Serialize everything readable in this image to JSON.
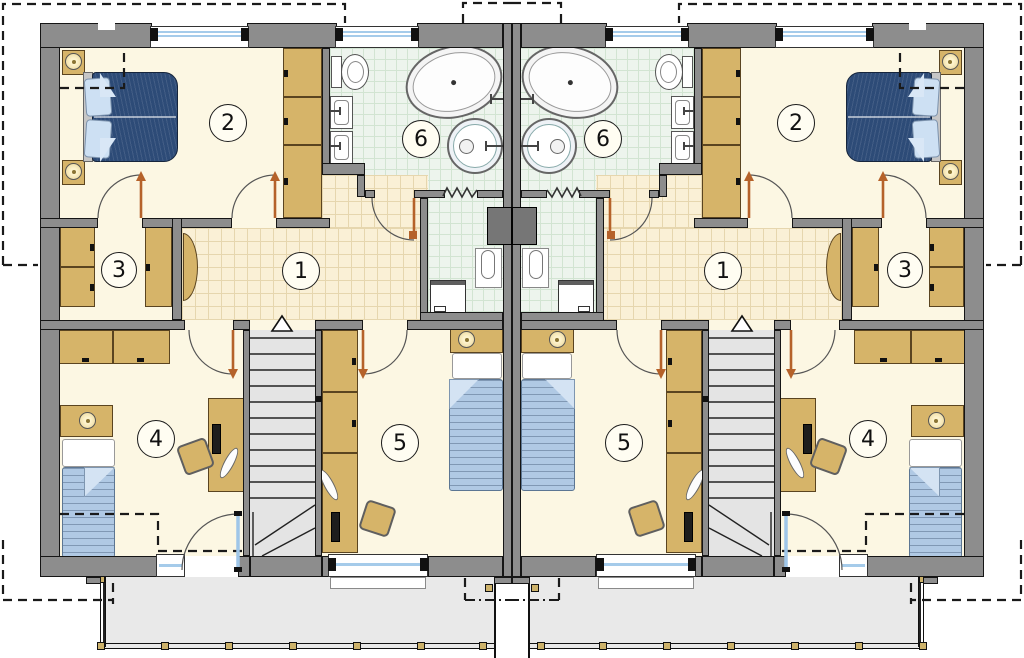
{
  "plan": {
    "type": "floor-plan",
    "rooms": {
      "r1": {
        "label": "1"
      },
      "r2": {
        "label": "2"
      },
      "r3": {
        "label": "3"
      },
      "r4": {
        "label": "4"
      },
      "r5": {
        "label": "5"
      },
      "r6": {
        "label": "6"
      }
    },
    "colors": {
      "wall": "#8d8d8d",
      "wallEdge": "#151515",
      "cream": "#fcf7e3",
      "hallBase": "#faf0d6",
      "hallLine": "#e6d6ae",
      "bathBase": "#edf4ed",
      "bathLine": "#d2e4d2",
      "wood": "#d6b469",
      "woodEdge": "#5a4420",
      "navy": "#2d4b77",
      "pillow": "#cde0f3",
      "blanket": "#b0c9e4",
      "terrace": "#e9e9e9",
      "stair": "#e4e4e4",
      "glazing": "#a5cbea",
      "leaf": "#b5622a",
      "chimney": "#767676"
    }
  }
}
